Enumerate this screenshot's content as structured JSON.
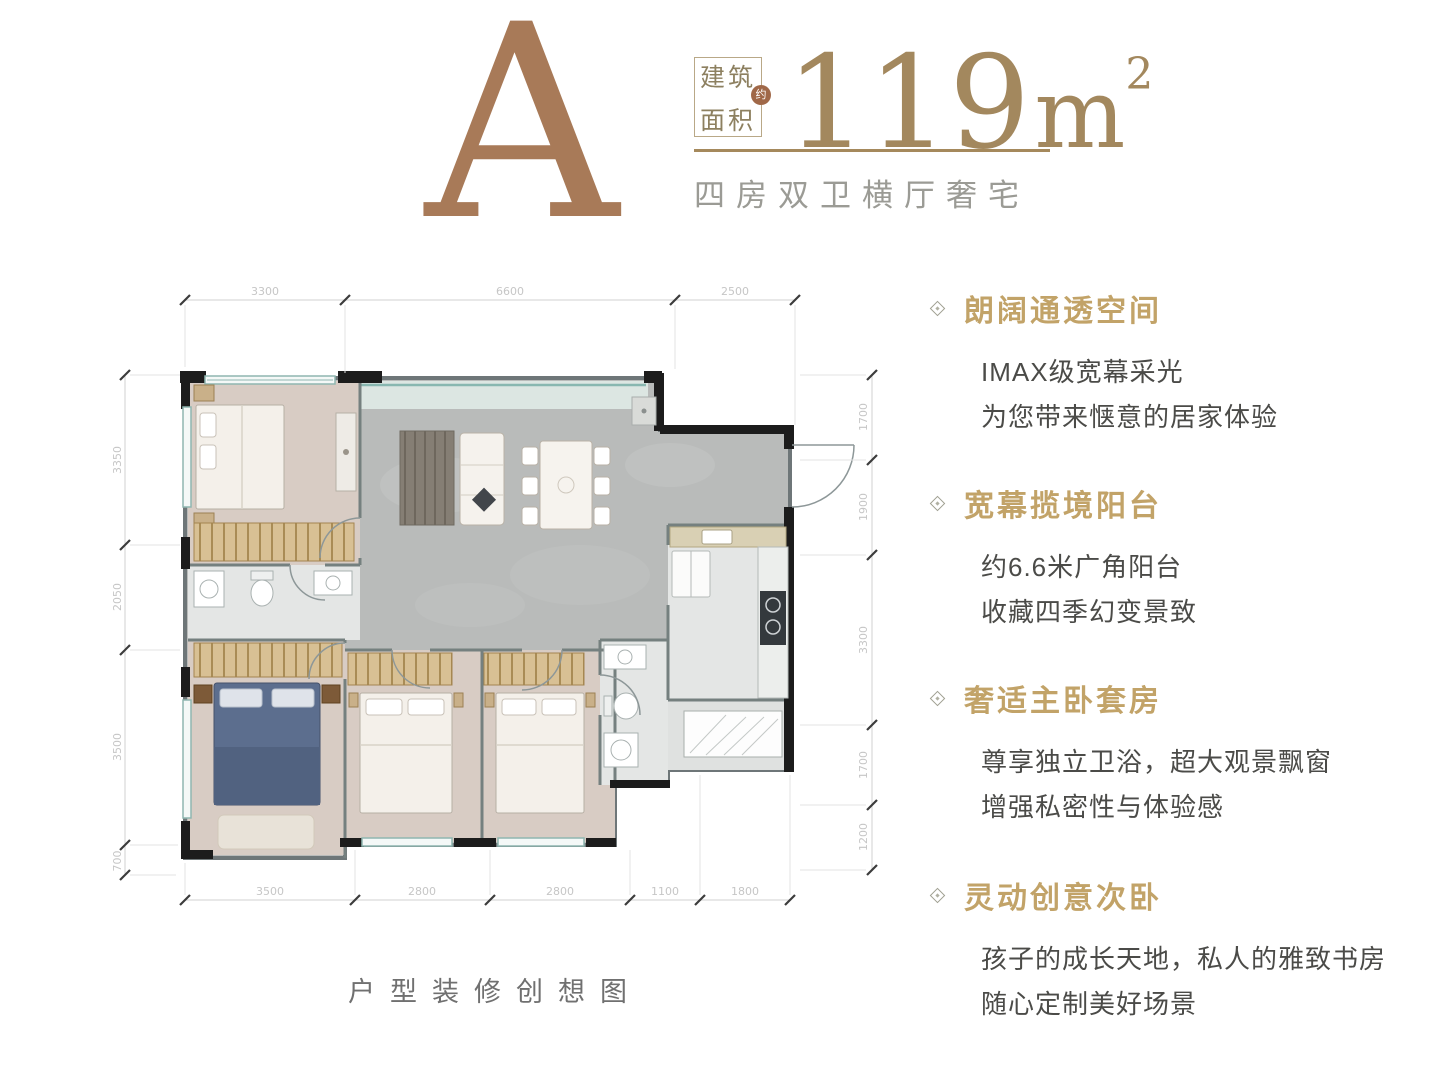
{
  "header": {
    "unit_letter": "A",
    "area_label_top": "建筑",
    "area_label_bottom": "面积",
    "area_seal": "约",
    "area_value": "119",
    "area_unit": "m",
    "area_unit_sup": "2",
    "subtitle": "四房双卫横厅奢宅"
  },
  "features": [
    {
      "title": "朗阔通透空间",
      "lines": [
        "IMAX级宽幕采光",
        "为您带来惬意的居家体验"
      ]
    },
    {
      "title": "宽幕揽境阳台",
      "lines": [
        "约6.6米广角阳台",
        "收藏四季幻变景致"
      ]
    },
    {
      "title": "奢适主卧套房",
      "lines": [
        "尊享独立卫浴，超大观景飘窗",
        "增强私密性与体验感"
      ]
    },
    {
      "title": "灵动创意次卧",
      "lines": [
        "孩子的成长天地，私人的雅致书房",
        "随心定制美好场景"
      ]
    }
  ],
  "floor_plan": {
    "caption": "户型装修创想图",
    "dimensions": {
      "top": [
        "3300",
        "6600",
        "2500"
      ],
      "bottom": [
        "3500",
        "2800",
        "2800",
        "1100",
        "1800"
      ],
      "left": [
        "3350",
        "2050",
        "3500",
        "700"
      ],
      "right": [
        "1700",
        "1900",
        "3300",
        "1700",
        "1200"
      ]
    }
  },
  "colors": {
    "letter_brown": "#a87a58",
    "accent_gold": "#a3885e",
    "feature_gold": "#c2a368",
    "wall_black": "#1c1c1c",
    "living_floor": "#b9bbba",
    "bedroom_floor": "#d8ccc4",
    "balcony_glass": "#88b7b0"
  }
}
